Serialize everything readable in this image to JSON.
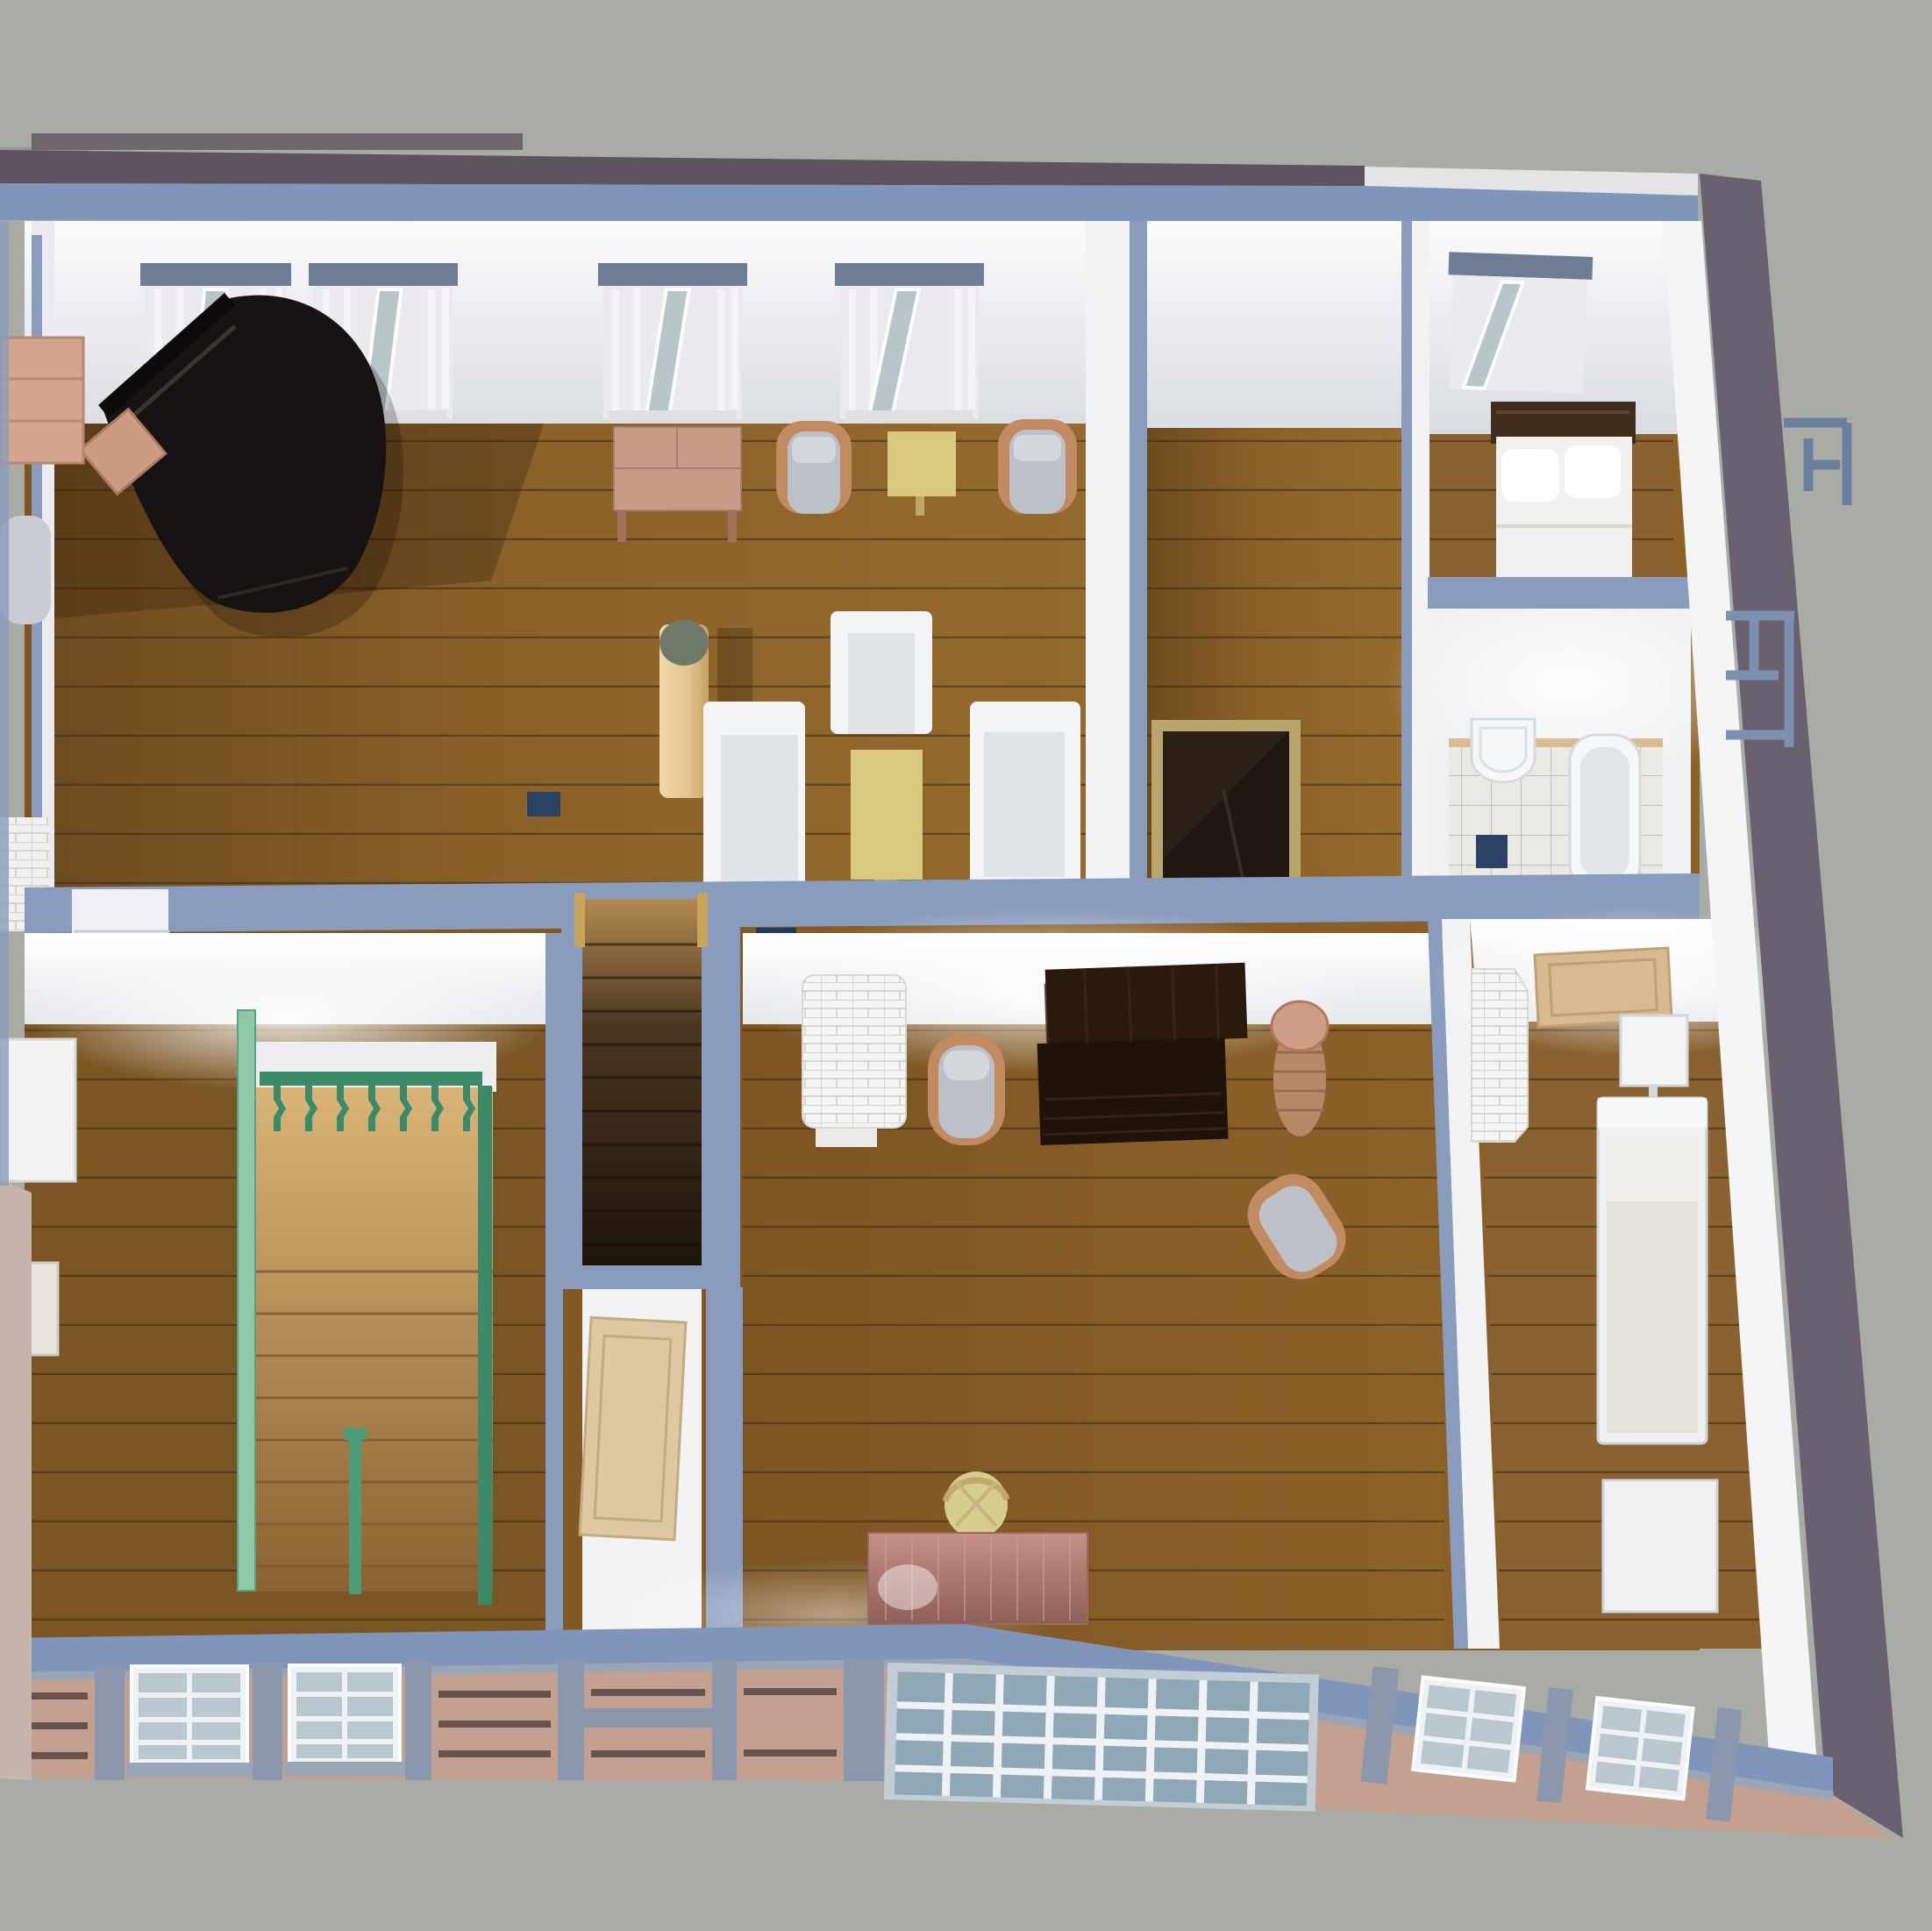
{
  "scene": {
    "kind": "3d-dollhouse-cutaway-render",
    "description": "top-down perspective cutaway of an upper storey of a house model",
    "rooms": [
      "music-living-room",
      "dining-hall",
      "bedroom-north",
      "bathroom",
      "stair-hall",
      "staircase",
      "study",
      "bedroom-south"
    ],
    "furniture": [
      "grand-piano",
      "piano-bench",
      "console-table",
      "armchair-pair",
      "tea-table",
      "column",
      "sofa-left",
      "sofa-right",
      "armchair-white",
      "coffee-table",
      "bed-north",
      "sink",
      "bathtub",
      "stairwell-opening",
      "green-balustrade",
      "stairs-down",
      "tiled-stove-study",
      "tiled-stove-corner",
      "secretary-desk",
      "gray-armchair",
      "serving-trolley",
      "writing-desk",
      "desk-chair",
      "nightstand",
      "bed-south",
      "chest"
    ],
    "window_units_back_wall": 5,
    "facade_windows": 5
  },
  "colors": {
    "background": "#a9aca4",
    "background_step": "#95978f",
    "roof_strip": "#5d5460",
    "roof_back_strip": "#6f676b",
    "outer_wall_blue": "#8095ba",
    "wall_cut_blue": "#8a9cbd",
    "wall_white": "#f2f3f5",
    "wall_glow": "#ffffff",
    "floor_wood": "#8a6128",
    "floor_wood_dark": "#6e4b1f",
    "floor_wood_light": "#946a2e",
    "plank_line": "#3a2610",
    "curtain": "#e9e9ee",
    "window_header": "#6e7c94",
    "window_glass": "#b7c6c9",
    "piano_black": "#161312",
    "bench_wood": "#cb9b82",
    "table_wood": "#c79d88",
    "chair_wood": "#c18a60",
    "cushion_gray": "#bcc1c8",
    "table_yellow": "#d9c87e",
    "column_tan": "#e3c48f",
    "column_top": "#6f7a6a",
    "sofa_white": "#f4f5f6",
    "sofa_seat": "#e0e3e8",
    "stairwell_dark": "#201711",
    "stairwell_rim": "#b8a66e",
    "bed_headboard": "#3f2d1d",
    "bedding_white": "#f2f1ef",
    "tile_floor": "#e9eae4",
    "tile_line": "#787d82",
    "fixture_white": "#f5f7f8",
    "chimney_navy": "#2a4263",
    "stair_wood_top": "#b28a50",
    "stair_wood_deep": "#1d140c",
    "hall_stairs_light": "#d9b476",
    "railing_green": "#3c8a69",
    "railing_green_light": "#8fc7a9",
    "stove_white": "#f5f6f3",
    "desk_dark": "#2a1a0e",
    "desk_pink": "#b07a70",
    "chair_pale": "#d6cc8e",
    "door_tan": "#d9ba90",
    "facade_pink": "#c3a08f",
    "facade_frame": "#8b97ad",
    "facade_glass": "#8fa8b5",
    "exterior_mauve": "#6a6170"
  }
}
